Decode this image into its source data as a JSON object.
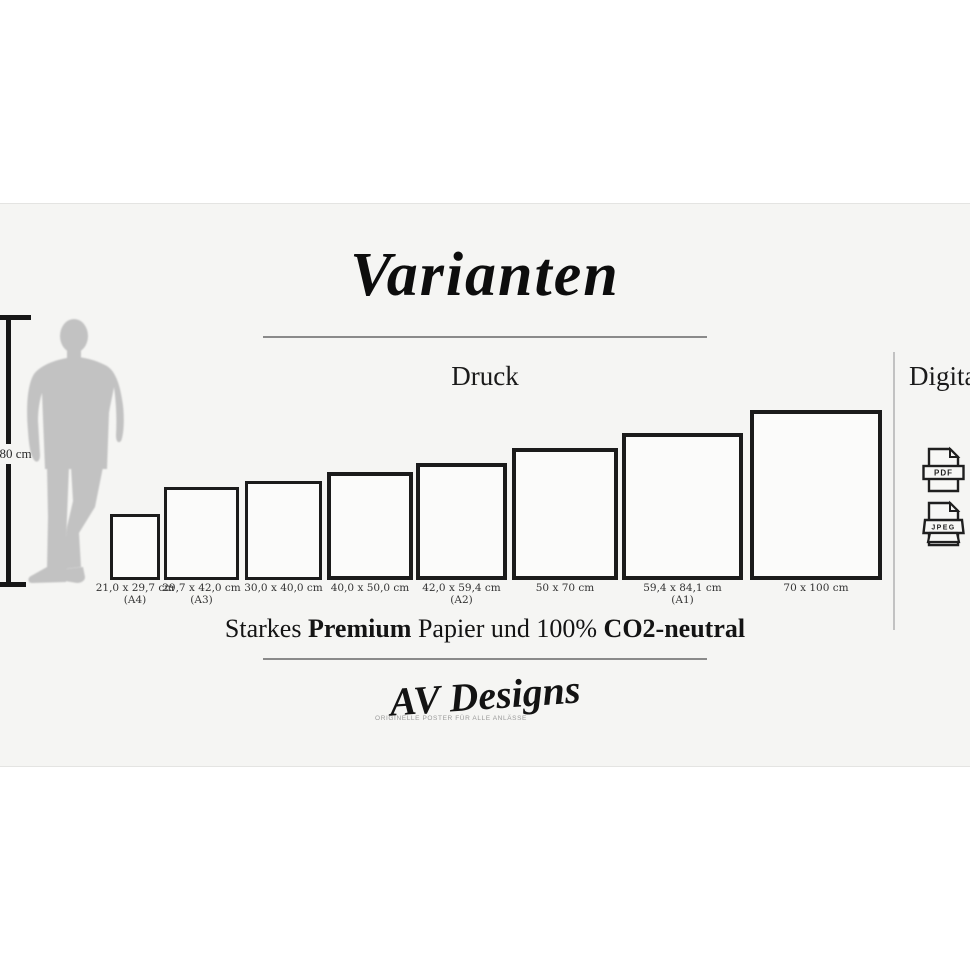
{
  "title": "Varianten",
  "sections": {
    "print_label": "Druck",
    "digital_label": "Digital"
  },
  "scale_figure": {
    "height_label": "180 cm"
  },
  "print_sizes": [
    {
      "size": "21,0 x 29,7 cm",
      "format": "(A4)",
      "left": 110,
      "width": 50,
      "height": 66
    },
    {
      "size": "29,7 x 42,0 cm",
      "format": "(A3)",
      "left": 164,
      "width": 75,
      "height": 93
    },
    {
      "size": "30,0 x 40,0 cm",
      "format": "",
      "left": 245,
      "width": 77,
      "height": 99
    },
    {
      "size": "40,0 x 50,0 cm",
      "format": "",
      "left": 327,
      "width": 86,
      "height": 108
    },
    {
      "size": "42,0 x 59,4 cm",
      "format": "(A2)",
      "left": 416,
      "width": 91,
      "height": 117
    },
    {
      "size": "50 x 70 cm",
      "format": "",
      "left": 512,
      "width": 106,
      "height": 132
    },
    {
      "size": "59,4 x 84,1 cm",
      "format": "(A1)",
      "left": 622,
      "width": 121,
      "height": 147
    },
    {
      "size": "70 x 100 cm",
      "format": "",
      "left": 750,
      "width": 132,
      "height": 170
    }
  ],
  "digital_formats": [
    "PDF",
    "JPEG"
  ],
  "quality_line": {
    "part1": "Starkes ",
    "part2_bold": "Premium",
    "part3": " Papier und 100% ",
    "part4_bold": "CO2-neutral"
  },
  "brand": {
    "name": "AV Designs",
    "tagline": "ORIGINELLE POSTER FÜR ALLE ANLÄSSE"
  },
  "colors": {
    "panel_bg": "#f5f5f3",
    "frame_border": "#1b1b1b",
    "silhouette": "#c2c2c2",
    "divider": "#8a8a8a",
    "section_divider": "#c2c2c2"
  }
}
